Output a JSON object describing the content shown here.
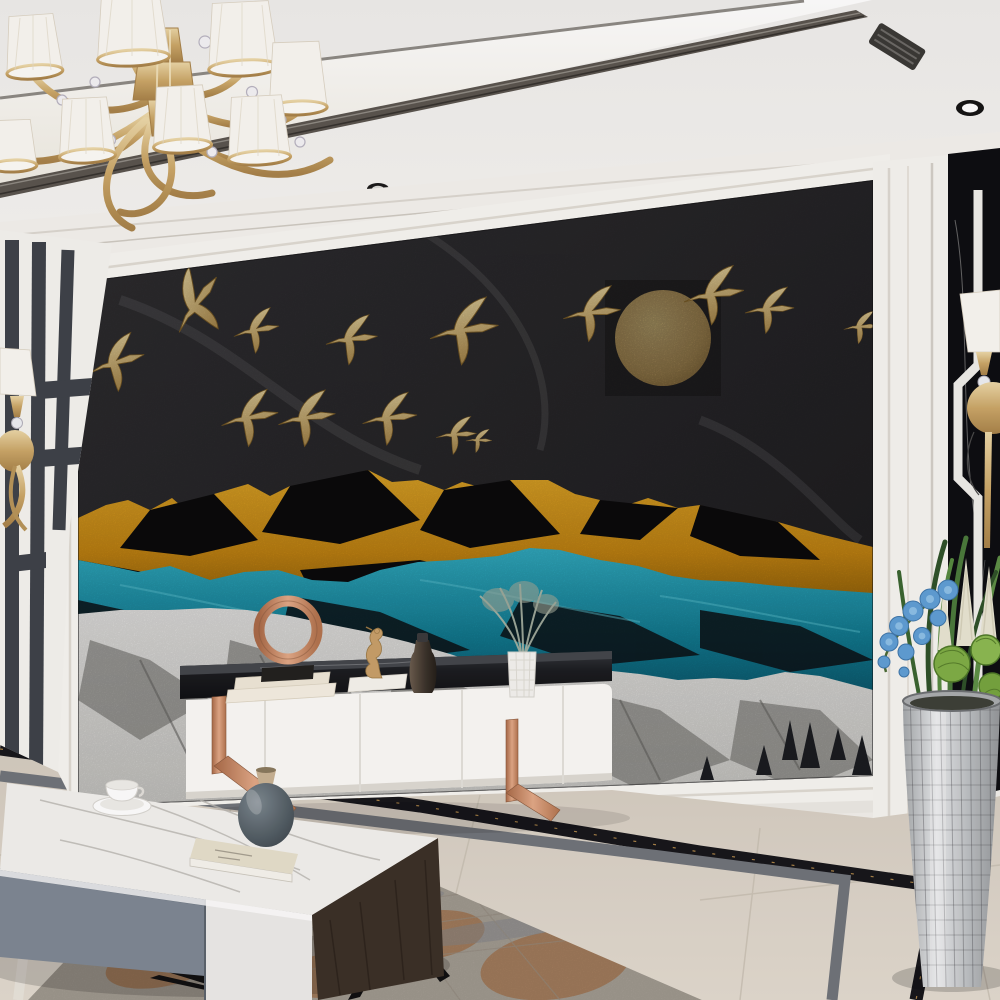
{
  "meta": {
    "description": "Photorealistic modern living-room render: feature wall mural of golden flying cranes over a gold moon and layered gold, teal and snowy mountain ridges; gold chandelier, white TV console with copper legs, marble coffee table, silver mosaic planter",
    "visible_text": "none"
  },
  "palette": {
    "wall": "#f2f0ec",
    "ceiling": "#f5f4f1",
    "coveLight": "#fffdf8",
    "trimDark": "#4b4742",
    "muralSky": "#2b2b2e",
    "muralSkyDeep": "#1e1e21",
    "gold": "#c9a45c",
    "goldBright": "#e6cf94",
    "goldDeep": "#8a6a2f",
    "mountainGold": "#e2a01e",
    "mountainGoldDark": "#9a6a07",
    "ridgeBlack": "#0a0a0b",
    "teal": "#1ca9c4",
    "tealDeep": "#0b6b85",
    "snow": "#f3f3f0",
    "snowShadow": "#8f8f8b",
    "treeDark": "#1d2126",
    "consoleWhite": "#fbfaf7",
    "consoleTop": "#1d1f24",
    "copper": "#c98a67",
    "floorMarble": "#d9d2c6",
    "inlayBlack": "#16161b",
    "inlayGray": "#70747a",
    "rugBase": "#b2aba0",
    "rugRust": "#b06a35",
    "tableMarble": "#f3f2ef",
    "tableBlueGray": "#7e8894",
    "tableWood": "#3b3027",
    "panelBlack": "#0c0d11",
    "planterSilver": "#c9ccce",
    "leafGreen": "#4a7a3c",
    "cactusGreen": "#7fae46",
    "orchidBlue": "#5f9fd6",
    "plumeCream": "#e9e5d3",
    "vaseGray": "#59646b"
  },
  "scene": {
    "ceiling": {
      "spotlight_count": 5,
      "feature": "recessed LED cove with dark metal trim"
    },
    "chandelier": {
      "finish": "gold",
      "shade_style": "white pleated",
      "shade_count": 8,
      "crystal_accents": true
    },
    "mural": {
      "bird_count": 14,
      "moon": "textured golden full moon",
      "layers": [
        "dark marble sky",
        "golden mountain ridge with black peaks",
        "teal mountain ridge",
        "snowy grey mountain ridge with pines"
      ]
    },
    "left_wall": {
      "pattern": "dark vertical stripe fretwork",
      "sconce": "gold with white shade"
    },
    "right_wall": {
      "panel": "black marble with white fretwork inlay",
      "sconce": "gold disc with white shade"
    },
    "tv_console": {
      "drawer_count": 4,
      "top": "black marble slab",
      "legs": "copper sled legs",
      "items": [
        "copper ring sculpture on stacked books",
        "seahorse figurine on white book",
        "dark bottle vase",
        "white geometric vase with dried silver plant"
      ]
    },
    "coffee_table": {
      "top": "white marble",
      "fronts": [
        "blue-grey drawer",
        "white drawer"
      ],
      "side": "dark wood",
      "items": [
        "white coffee cup on saucer",
        "cream book",
        "grey round vase with wooden neck"
      ]
    },
    "floor": {
      "material": "beige marble tile",
      "inlay": "black-gold and grey border strips"
    },
    "rug": {
      "style": "distressed grey with rust patches"
    },
    "planter": {
      "finish": "silver mosaic",
      "contents": [
        "green blades",
        "blue orchid spray",
        "cream plumes",
        "round cacti"
      ]
    }
  }
}
